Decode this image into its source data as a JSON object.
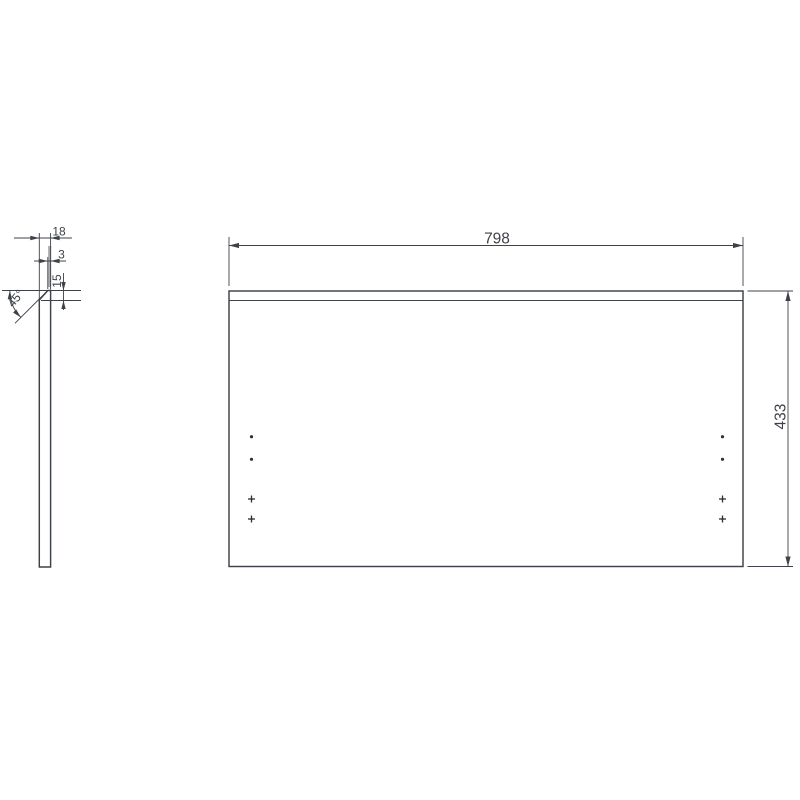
{
  "drawing": {
    "background": "#ffffff",
    "line_color": "#3d4148",
    "highlight_color": "#adadad",
    "front_view": {
      "width_label": "798",
      "height_label": "433",
      "drill_holes": {
        "left_column": 4,
        "right_column": 4,
        "round_per_column": 2,
        "cross_per_column": 2
      }
    },
    "profile_view": {
      "thickness_label": "18",
      "top_flat_label": "3",
      "chamfer_height_label": "15",
      "chamfer_angle_label": "45°"
    },
    "part": {
      "width_mm": 798,
      "height_mm": 433,
      "thickness_mm": 18,
      "chamfer_angle_deg": 45,
      "chamfer_run_mm": 15,
      "top_flat_mm": 3
    }
  }
}
